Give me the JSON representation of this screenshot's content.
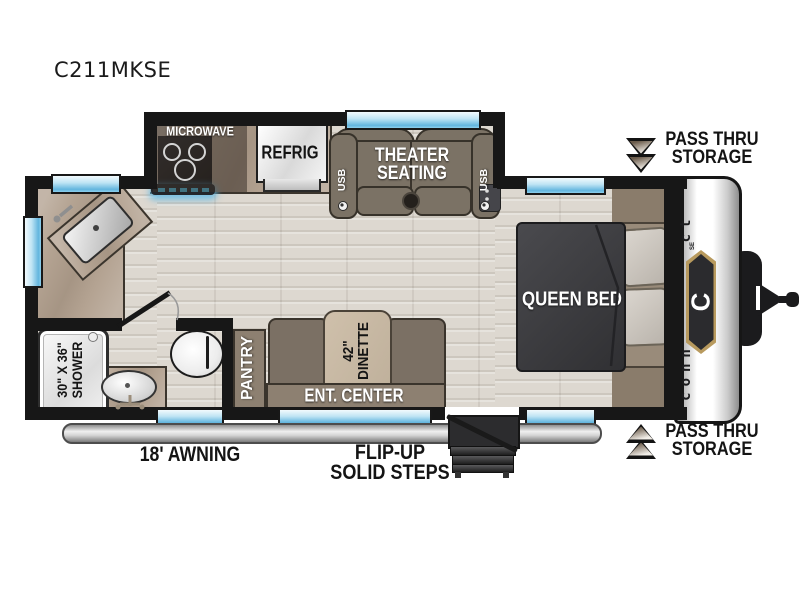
{
  "title": "C211MKSE",
  "floorplan": {
    "kitchen": {
      "microwave": "MICROWAVE",
      "refrigerator": "REFRIG"
    },
    "living": {
      "theater_seating": [
        "THEATER",
        "SEATING"
      ],
      "usb_left": "USB",
      "usb_right": "USB"
    },
    "bedroom": {
      "bed": "QUEEN BED"
    },
    "bathroom": {
      "shower": [
        "30\" X 36\"",
        "SHOWER"
      ]
    },
    "dinette": {
      "table": [
        "42\"",
        "DINETTE"
      ]
    },
    "ent_center": "ENT. CENTER",
    "pantry": "PANTRY"
  },
  "exterior": {
    "awning": "18' AWNING",
    "steps": [
      "FLIP-UP",
      "SOLID STEPS"
    ],
    "storage_top": [
      "PASS THRU",
      "STORAGE"
    ],
    "storage_bottom": [
      "PASS THRU",
      "STORAGE"
    ],
    "brand": {
      "lower": "conn",
      "upper": "ct",
      "badge": "C",
      "series": "SE"
    }
  },
  "colors": {
    "wall": "#171717",
    "window_blue": "#62b5de",
    "counter_tan": "#b4a392",
    "sofa_brown": "#7b7265",
    "cabinet_brown": "#8d8071",
    "bed_dark": "#3a3a3c",
    "floor_wood": "#ddd8d0",
    "badge_gold": "#b89a5e",
    "usb_accent": "#49c3ec"
  }
}
